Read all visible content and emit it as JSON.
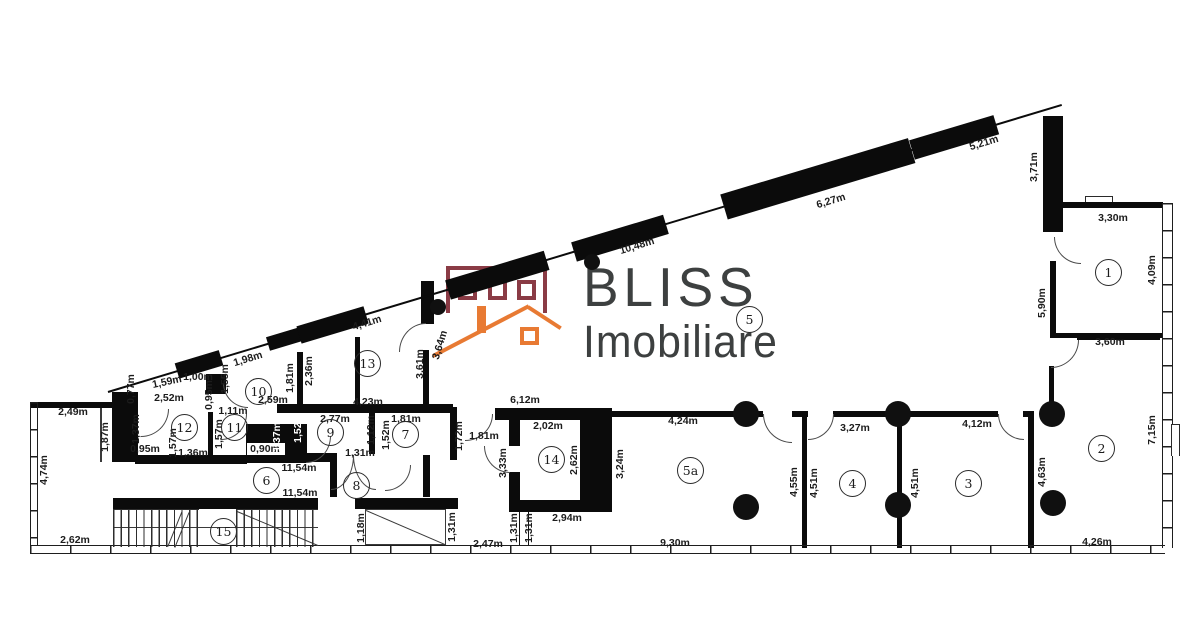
{
  "meta": {
    "width": 1200,
    "height": 624,
    "background": "#ffffff"
  },
  "logo": {
    "line1": "BLISS",
    "line2": "Imobiliare",
    "text_color": "#3d4040",
    "house_outline_color": "#8a3b45",
    "roof_color": "#e87a33"
  },
  "plan": {
    "wall_color": "#0b0b0b",
    "label_color": "#1c1c1c",
    "unit": "m",
    "rooms": [
      {
        "n": "1",
        "x": 1108,
        "y": 272
      },
      {
        "n": "2",
        "x": 1101,
        "y": 448
      },
      {
        "n": "3",
        "x": 968,
        "y": 483
      },
      {
        "n": "4",
        "x": 852,
        "y": 483
      },
      {
        "n": "5",
        "x": 749,
        "y": 319
      },
      {
        "n": "5a",
        "x": 690,
        "y": 470
      },
      {
        "n": "6",
        "x": 266,
        "y": 480
      },
      {
        "n": "7",
        "x": 405,
        "y": 434
      },
      {
        "n": "8",
        "x": 356,
        "y": 485
      },
      {
        "n": "9",
        "x": 330,
        "y": 432
      },
      {
        "n": "10",
        "x": 258,
        "y": 391
      },
      {
        "n": "11",
        "x": 234,
        "y": 427
      },
      {
        "n": "12",
        "x": 184,
        "y": 427
      },
      {
        "n": "13",
        "x": 367,
        "y": 363
      },
      {
        "n": "14",
        "x": 551,
        "y": 459
      },
      {
        "n": "15",
        "x": 223,
        "y": 531
      }
    ],
    "labels": [
      {
        "t": "5,21m",
        "x": 984,
        "y": 143,
        "r": -17
      },
      {
        "t": "6,27m",
        "x": 831,
        "y": 201,
        "r": -17
      },
      {
        "t": "10,48m",
        "x": 637,
        "y": 246,
        "r": -17
      },
      {
        "t": "4,41m",
        "x": 367,
        "y": 323,
        "r": -17
      },
      {
        "t": "1,98m",
        "x": 248,
        "y": 359,
        "r": -17
      },
      {
        "t": "1,59m",
        "x": 167,
        "y": 382,
        "r": -12
      },
      {
        "t": "3,71m",
        "x": 1034,
        "y": 167,
        "r": -90
      },
      {
        "t": "3,30m",
        "x": 1113,
        "y": 218,
        "r": 0
      },
      {
        "t": "4,09m",
        "x": 1152,
        "y": 270,
        "r": -90
      },
      {
        "t": "5,90m",
        "x": 1042,
        "y": 303,
        "r": -90
      },
      {
        "t": "3,60m",
        "x": 1110,
        "y": 342,
        "r": 0
      },
      {
        "t": "7,15m",
        "x": 1152,
        "y": 430,
        "r": -90
      },
      {
        "t": "4,26m",
        "x": 1097,
        "y": 542,
        "r": 0
      },
      {
        "t": "4,63m",
        "x": 1042,
        "y": 472,
        "r": -90
      },
      {
        "t": "4,12m",
        "x": 977,
        "y": 424,
        "r": 0
      },
      {
        "t": "4,51m",
        "x": 915,
        "y": 483,
        "r": -90
      },
      {
        "t": "3,27m",
        "x": 855,
        "y": 428,
        "r": 0
      },
      {
        "t": "4,51m",
        "x": 814,
        "y": 483,
        "r": -90
      },
      {
        "t": "4,55m",
        "x": 794,
        "y": 482,
        "r": -90
      },
      {
        "t": "4,24m",
        "x": 683,
        "y": 421,
        "r": 0
      },
      {
        "t": "9,30m",
        "x": 675,
        "y": 543,
        "r": 0
      },
      {
        "t": "3,24m",
        "x": 620,
        "y": 464,
        "r": -90
      },
      {
        "t": "6,12m",
        "x": 525,
        "y": 400,
        "r": 0
      },
      {
        "t": "2,02m",
        "x": 548,
        "y": 426,
        "r": 0
      },
      {
        "t": "2,62m",
        "x": 574,
        "y": 460,
        "r": -90
      },
      {
        "t": "3,33m",
        "x": 503,
        "y": 463,
        "r": -90
      },
      {
        "t": "2,94m",
        "x": 567,
        "y": 518,
        "r": 0
      },
      {
        "t": "1,31m",
        "x": 514,
        "y": 528,
        "r": -90
      },
      {
        "t": "1,31m",
        "x": 529,
        "y": 528,
        "r": -90
      },
      {
        "t": "2,47m",
        "x": 488,
        "y": 544,
        "r": 0
      },
      {
        "t": "1,31m",
        "x": 452,
        "y": 527,
        "r": -90
      },
      {
        "t": "1,18m",
        "x": 361,
        "y": 528,
        "r": -90
      },
      {
        "t": "11,54m",
        "x": 300,
        "y": 493,
        "r": 0
      },
      {
        "t": "11,54m",
        "x": 299,
        "y": 468,
        "r": 0
      },
      {
        "t": "1,81m",
        "x": 484,
        "y": 436,
        "r": 0
      },
      {
        "t": "1,72m",
        "x": 459,
        "y": 436,
        "r": -90
      },
      {
        "t": "1,81m",
        "x": 406,
        "y": 419,
        "r": 0
      },
      {
        "t": "1,52m",
        "x": 386,
        "y": 435,
        "r": -90
      },
      {
        "t": "1,12m",
        "x": 371,
        "y": 430,
        "r": -90
      },
      {
        "t": "2,77m",
        "x": 335,
        "y": 419,
        "r": 0
      },
      {
        "t": "1,31m",
        "x": 360,
        "y": 453,
        "r": 0
      },
      {
        "t": "0,90m",
        "x": 265,
        "y": 449,
        "r": 0
      },
      {
        "t": "1,11m",
        "x": 233,
        "y": 411,
        "r": 0
      },
      {
        "t": "1,57m",
        "x": 219,
        "y": 434,
        "r": -90
      },
      {
        "t": "1,36m",
        "x": 193,
        "y": 453,
        "r": 0
      },
      {
        "t": "1,57m",
        "x": 173,
        "y": 443,
        "r": -90
      },
      {
        "t": "0,95m",
        "x": 145,
        "y": 449,
        "r": 0
      },
      {
        "t": "1,37m",
        "x": 136,
        "y": 429,
        "r": -90
      },
      {
        "t": "2,52m",
        "x": 169,
        "y": 398,
        "r": 0
      },
      {
        "t": "1,00m",
        "x": 198,
        "y": 377,
        "r": 0
      },
      {
        "t": "0,77m",
        "x": 131,
        "y": 389,
        "r": -90
      },
      {
        "t": "0,95m",
        "x": 209,
        "y": 395,
        "r": -90
      },
      {
        "t": "1,55m",
        "x": 225,
        "y": 379,
        "r": -90
      },
      {
        "t": "2,59m",
        "x": 273,
        "y": 400,
        "r": 0
      },
      {
        "t": "1,81m",
        "x": 290,
        "y": 378,
        "r": -90
      },
      {
        "t": "2,36m",
        "x": 309,
        "y": 371,
        "r": -90
      },
      {
        "t": "4,23m",
        "x": 368,
        "y": 402,
        "r": 0
      },
      {
        "t": "3,61m",
        "x": 420,
        "y": 364,
        "r": -90
      },
      {
        "t": "3,64m",
        "x": 440,
        "y": 345,
        "r": -73
      },
      {
        "t": "2,49m",
        "x": 73,
        "y": 412,
        "r": 0
      },
      {
        "t": "4,74m",
        "x": 44,
        "y": 470,
        "r": -90
      },
      {
        "t": "1,87m",
        "x": 105,
        "y": 437,
        "r": -90
      },
      {
        "t": "2,62m",
        "x": 75,
        "y": 540,
        "r": 0
      }
    ],
    "labels_light": [
      {
        "t": "1,37m",
        "x": 277,
        "y": 437,
        "r": -90
      },
      {
        "t": "1,52m",
        "x": 298,
        "y": 428,
        "r": -90
      }
    ],
    "walls": [
      [
        112,
        392,
        26,
        70
      ],
      [
        206,
        374,
        20,
        20
      ],
      [
        208,
        412,
        5,
        43
      ],
      [
        246,
        424,
        61,
        39
      ],
      [
        135,
        455,
        112,
        9
      ],
      [
        297,
        352,
        6,
        56
      ],
      [
        277,
        404,
        176,
        9
      ],
      [
        355,
        337,
        5,
        70
      ],
      [
        423,
        350,
        6,
        57
      ],
      [
        369,
        413,
        6,
        41
      ],
      [
        450,
        407,
        7,
        53
      ],
      [
        297,
        453,
        40,
        9
      ],
      [
        330,
        455,
        7,
        42
      ],
      [
        423,
        455,
        7,
        42
      ],
      [
        113,
        498,
        205,
        11
      ],
      [
        355,
        498,
        103,
        11
      ],
      [
        495,
        408,
        117,
        12
      ],
      [
        509,
        420,
        11,
        26
      ],
      [
        509,
        472,
        11,
        36
      ],
      [
        509,
        500,
        103,
        12
      ],
      [
        580,
        414,
        32,
        96
      ],
      [
        1043,
        116,
        20,
        116
      ],
      [
        1050,
        261,
        6,
        74
      ],
      [
        1050,
        333,
        113,
        5
      ],
      [
        1049,
        366,
        5,
        46
      ],
      [
        1028,
        412,
        6,
        136
      ],
      [
        802,
        415,
        5,
        133
      ],
      [
        897,
        413,
        5,
        135
      ],
      [
        612,
        411,
        151,
        6
      ],
      [
        792,
        411,
        16,
        6
      ],
      [
        833,
        411,
        165,
        6
      ],
      [
        1023,
        411,
        11,
        6
      ],
      [
        1077,
        334,
        83,
        6
      ],
      [
        1063,
        202,
        100,
        6
      ],
      [
        30,
        402,
        82,
        6
      ],
      [
        421,
        281,
        13,
        43
      ]
    ],
    "diag_walls": [
      [
        108,
        392,
        996,
        2
      ],
      [
        177,
        371,
        46,
        16
      ],
      [
        268,
        344,
        33,
        14
      ],
      [
        299,
        335,
        70,
        18
      ],
      [
        448,
        290,
        103,
        20
      ],
      [
        574,
        252,
        96,
        20
      ],
      [
        724,
        207,
        196,
        26
      ],
      [
        912,
        150,
        88,
        20
      ]
    ],
    "diag_angle_deg": -16.75,
    "windows_v": [
      [
        1162,
        203,
        11,
        345
      ],
      [
        30,
        402,
        8,
        143
      ]
    ],
    "windows_h": [
      [
        30,
        545,
        1135,
        9
      ]
    ],
    "bumps": [
      [
        1085,
        196,
        28,
        6
      ],
      [
        1171,
        424,
        9,
        32
      ]
    ],
    "columns": [
      [
        592,
        262,
        16
      ],
      [
        438,
        307,
        16
      ],
      [
        746,
        414,
        26
      ],
      [
        746,
        507,
        26
      ],
      [
        898,
        414,
        26
      ],
      [
        898,
        505,
        26
      ],
      [
        1052,
        414,
        26
      ],
      [
        1053,
        503,
        26
      ]
    ],
    "arcs": [
      [
        1054,
        237,
        26,
        26,
        "bl"
      ],
      [
        1051,
        340,
        27,
        27,
        "br"
      ],
      [
        763,
        414,
        28,
        28,
        "bl"
      ],
      [
        808,
        414,
        25,
        25,
        "br"
      ],
      [
        998,
        414,
        25,
        25,
        "bl"
      ],
      [
        399,
        323,
        26,
        28,
        "tl"
      ],
      [
        465,
        414,
        27,
        26,
        "br"
      ],
      [
        484,
        446,
        25,
        26,
        "bl"
      ],
      [
        141,
        409,
        27,
        27,
        "br"
      ],
      [
        221,
        414,
        25,
        25,
        "br"
      ],
      [
        223,
        383,
        24,
        24,
        "bl"
      ],
      [
        306,
        436,
        24,
        26,
        "br"
      ],
      [
        331,
        455,
        22,
        34,
        "br"
      ],
      [
        353,
        455,
        22,
        34,
        "bl"
      ],
      [
        385,
        465,
        25,
        25,
        "br"
      ]
    ],
    "thin_lines": [
      [
        100,
        408,
        1.5,
        54,
        0
      ],
      [
        113,
        527,
        205,
        1.2,
        0
      ],
      [
        237,
        511,
        88,
        1.4,
        22.8
      ],
      [
        168,
        546,
        38,
        1.4,
        -68
      ],
      [
        175,
        547,
        38,
        1.4,
        -68
      ],
      [
        366,
        510,
        87,
        1.2,
        23.3
      ]
    ],
    "stairs": {
      "flight1": [
        113,
        509,
        86,
        37
      ],
      "flight2": [
        236,
        509,
        82,
        37
      ]
    },
    "shaft_box": [
      365,
      509,
      81,
      36
    ],
    "connector": [
      519,
      512,
      8,
      33
    ],
    "white_patch": [
      247,
      443,
      38,
      12
    ]
  }
}
